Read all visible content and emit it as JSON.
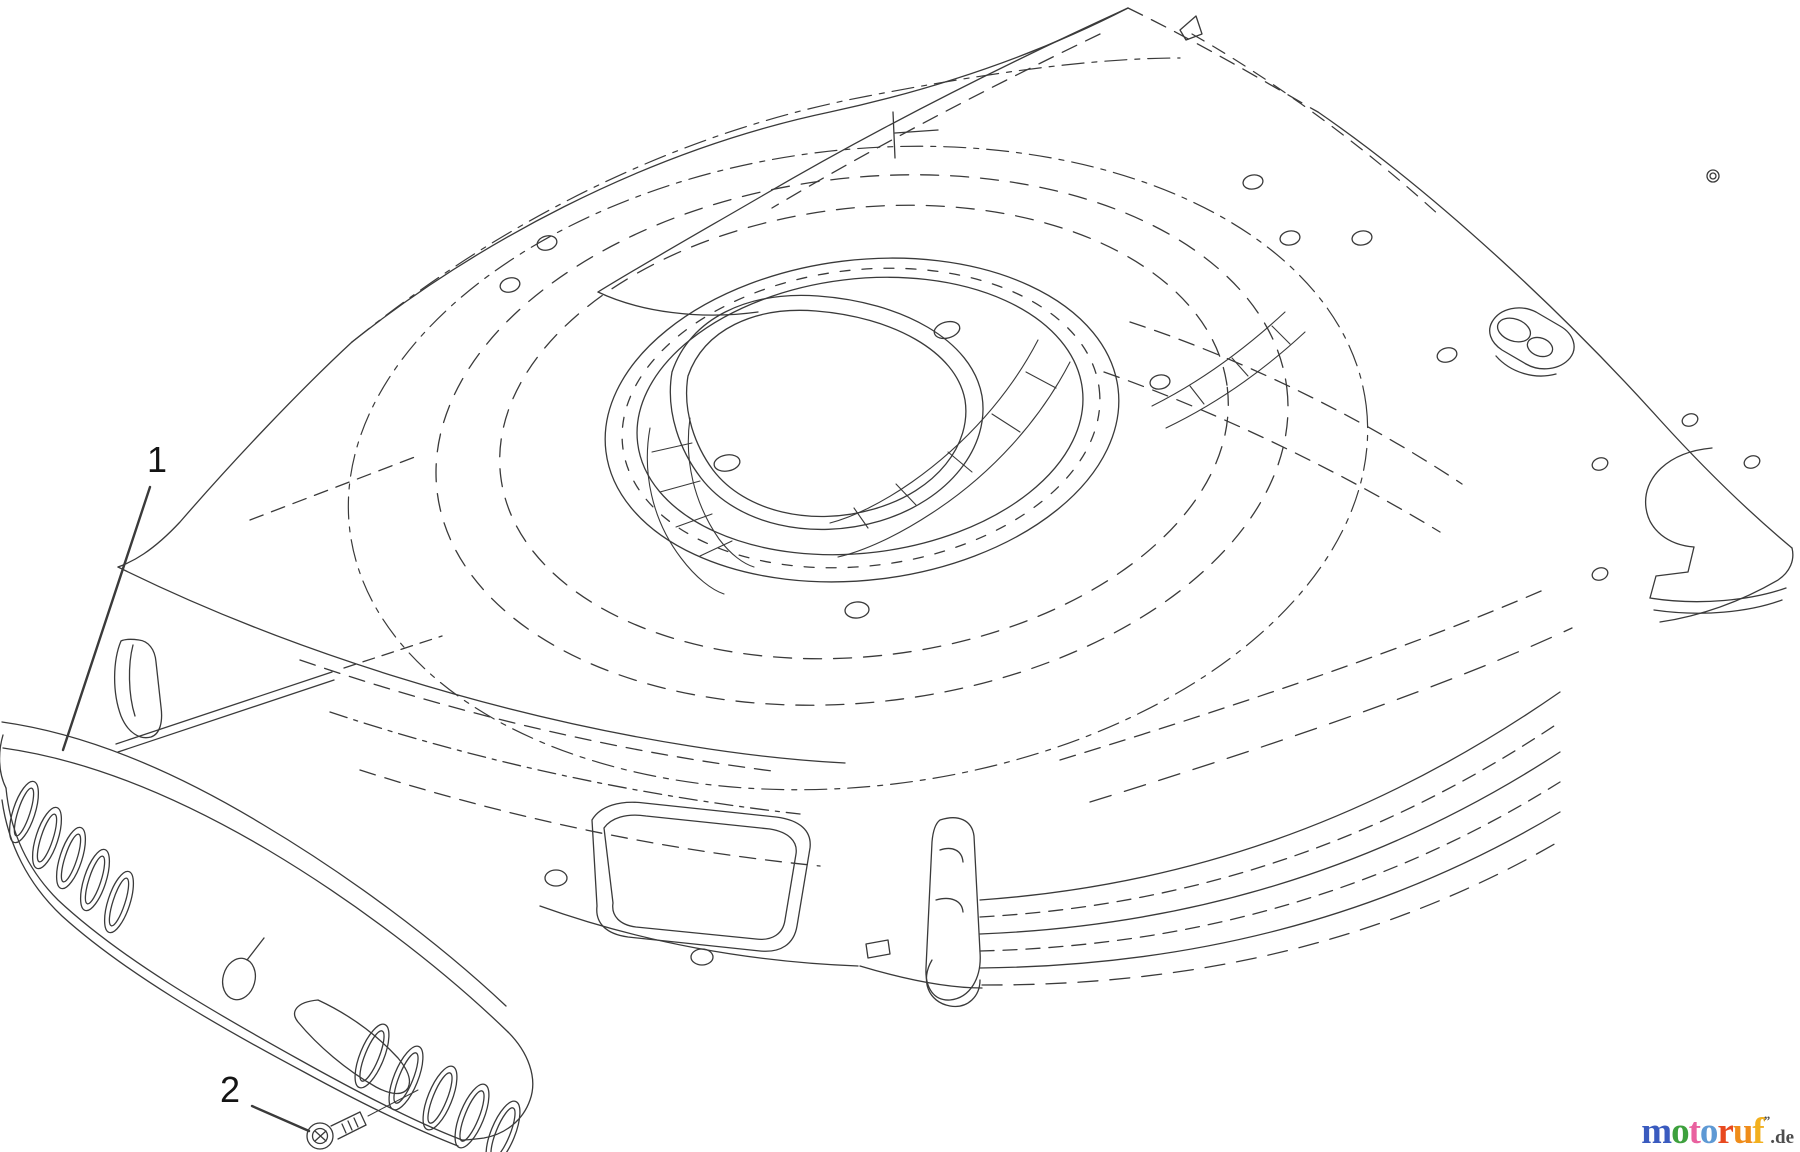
{
  "diagram": {
    "line_color": "#3a3a3a",
    "callout_color": "#141414",
    "callouts": [
      {
        "label": "1"
      },
      {
        "label": "2"
      }
    ]
  },
  "logo": {
    "letters": [
      {
        "char": "m",
        "color": "#3a5bbf"
      },
      {
        "char": "o",
        "color": "#3da03d"
      },
      {
        "char": "t",
        "color": "#e9619f"
      },
      {
        "char": "o",
        "color": "#5e99d4"
      },
      {
        "char": "r",
        "color": "#e8491f"
      },
      {
        "char": "u",
        "color": "#ef8c1a"
      },
      {
        "char": "f",
        "color": "#f2b01e"
      }
    ],
    "mark": "”",
    "suffix": ".de",
    "suffix_color": "#4d4d4d"
  }
}
